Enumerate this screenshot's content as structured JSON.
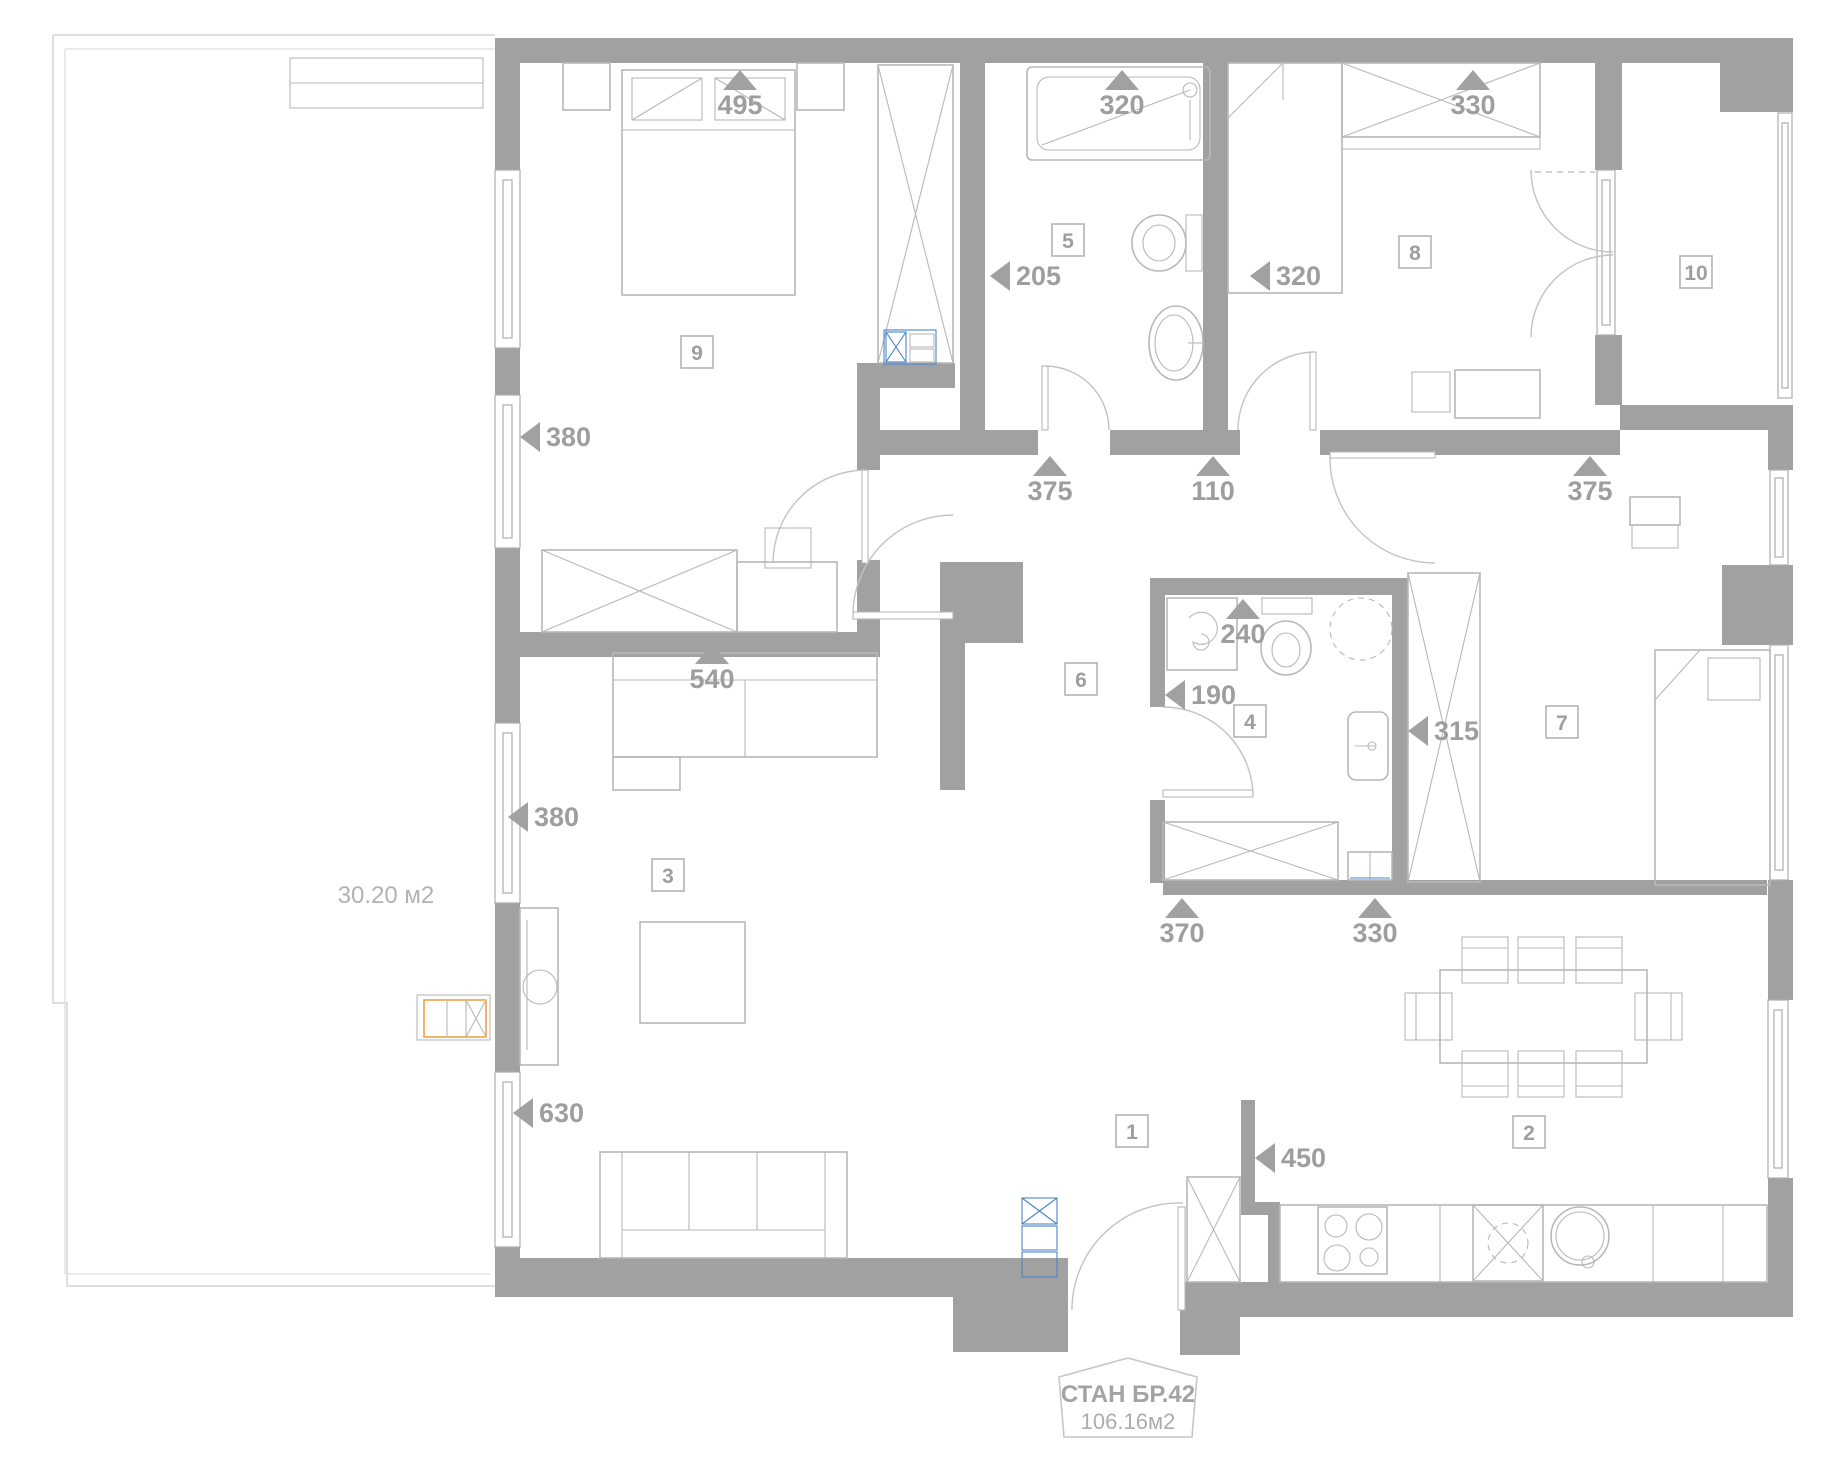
{
  "plan": {
    "unit_badge": {
      "title": "СТАН БР.42",
      "area": "106.16м2"
    },
    "terrace": {
      "area_label": "30.20 м2"
    },
    "rooms": [
      {
        "number": "1",
        "x": 1132,
        "y": 1131
      },
      {
        "number": "2",
        "x": 1529,
        "y": 1132
      },
      {
        "number": "3",
        "x": 668,
        "y": 875
      },
      {
        "number": "4",
        "x": 1250,
        "y": 721
      },
      {
        "number": "5",
        "x": 1068,
        "y": 240
      },
      {
        "number": "6",
        "x": 1081,
        "y": 679
      },
      {
        "number": "7",
        "x": 1562,
        "y": 722
      },
      {
        "number": "8",
        "x": 1415,
        "y": 252
      },
      {
        "number": "9",
        "x": 697,
        "y": 352
      },
      {
        "number": "10",
        "x": 1696,
        "y": 272
      }
    ],
    "dimensions": [
      {
        "value": "495",
        "marker": "up",
        "x": 740,
        "y": 104
      },
      {
        "value": "320",
        "marker": "up",
        "x": 1122,
        "y": 104
      },
      {
        "value": "330",
        "marker": "up",
        "x": 1473,
        "y": 104
      },
      {
        "value": "205",
        "marker": "left",
        "x": 990,
        "y": 276
      },
      {
        "value": "320",
        "marker": "left",
        "x": 1250,
        "y": 276
      },
      {
        "value": "380",
        "marker": "left",
        "x": 520,
        "y": 437
      },
      {
        "value": "375",
        "marker": "up",
        "x": 1050,
        "y": 490
      },
      {
        "value": "110",
        "marker": "up",
        "x": 1213,
        "y": 490
      },
      {
        "value": "375",
        "marker": "up",
        "x": 1590,
        "y": 490
      },
      {
        "value": "540",
        "marker": "up",
        "x": 712,
        "y": 678
      },
      {
        "value": "240",
        "marker": "up",
        "x": 1243,
        "y": 633
      },
      {
        "value": "190",
        "marker": "left",
        "x": 1165,
        "y": 695
      },
      {
        "value": "315",
        "marker": "left",
        "x": 1408,
        "y": 731
      },
      {
        "value": "380",
        "marker": "left",
        "x": 508,
        "y": 817
      },
      {
        "value": "370",
        "marker": "up",
        "x": 1182,
        "y": 932
      },
      {
        "value": "330",
        "marker": "up",
        "x": 1375,
        "y": 932
      },
      {
        "value": "630",
        "marker": "left",
        "x": 513,
        "y": 1113
      },
      {
        "value": "450",
        "marker": "left",
        "x": 1255,
        "y": 1158
      }
    ]
  },
  "colors": {
    "wall": "#a1a1a1",
    "furniture_line": "#b8b8b8",
    "label_text": "#9e9e9e",
    "appliance_blue": "#4a86c8",
    "accent_orange": "#eaa345",
    "terrace_line": "#dedede",
    "background": "#ffffff"
  }
}
